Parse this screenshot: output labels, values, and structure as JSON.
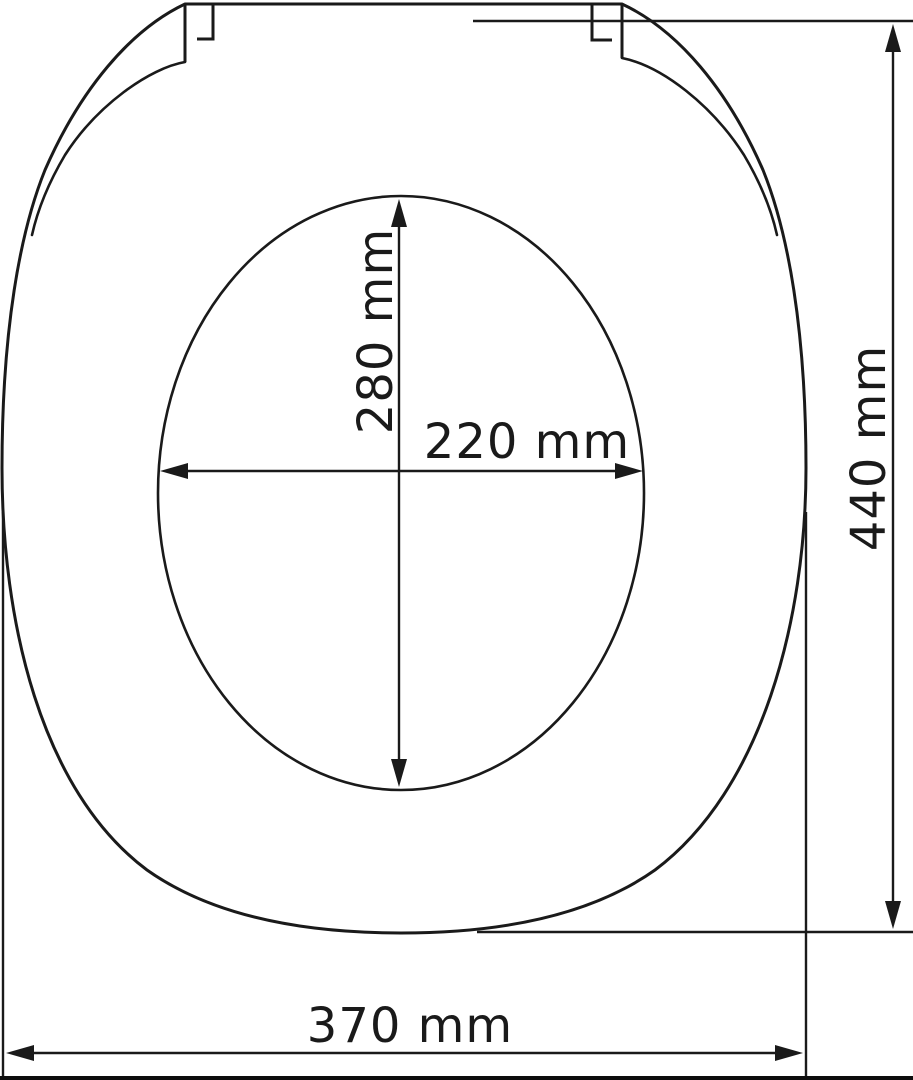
{
  "diagram": {
    "colors": {
      "line": "#1a1a1a",
      "background": "#ffffff"
    },
    "dimensions": {
      "opening_length": "280 mm",
      "opening_width": "220 mm",
      "overall_length": "440 mm",
      "overall_width": "370 mm"
    }
  }
}
